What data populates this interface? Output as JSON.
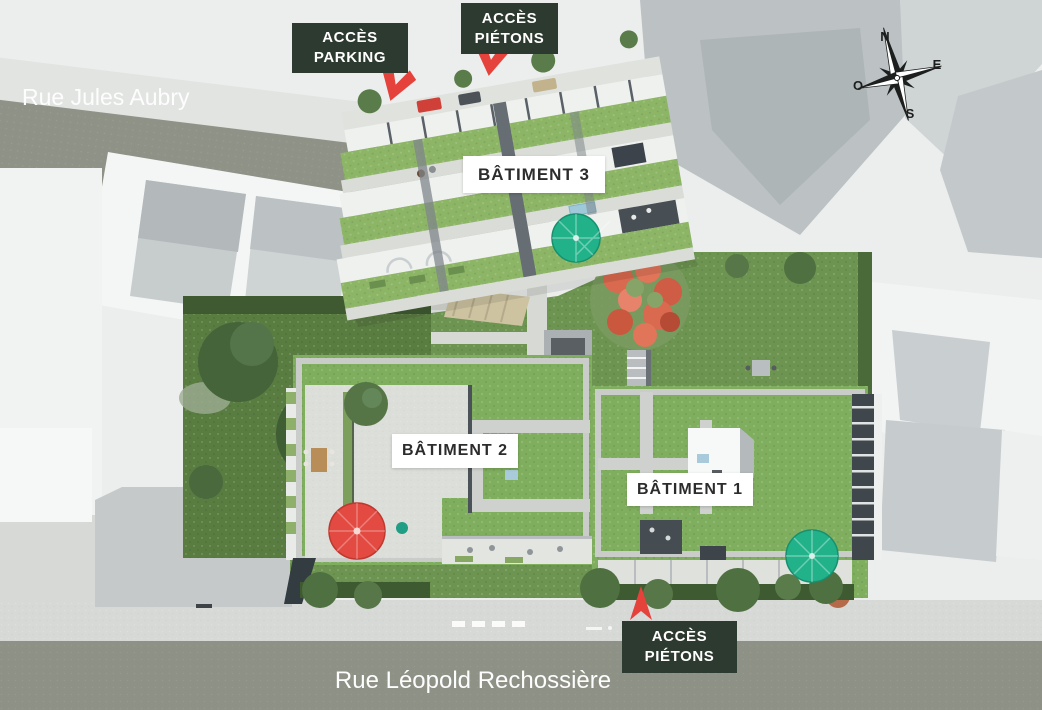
{
  "map": {
    "streets": {
      "top": "Rue Jules Aubry",
      "bottom": "Rue Léopold Rechossière"
    },
    "access": {
      "parking": {
        "line1": "ACCÈS",
        "line2": "PARKING"
      },
      "pedestrian_top": {
        "line1": "ACCÈS",
        "line2": "PIÉTONS"
      },
      "pedestrian_bottom": {
        "line1": "ACCÈS",
        "line2": "PIÉTONS"
      }
    },
    "buildings": {
      "b1": "BÂTIMENT 1",
      "b2": "BÂTIMENT 2",
      "b3": "BÂTIMENT 3"
    },
    "compass": {
      "north": "N",
      "east": "E",
      "south": "S",
      "west": "O"
    },
    "colors": {
      "label_box_green": "#2d3a30",
      "accent_red": "#e5423b",
      "accent_teal": "#22b28a",
      "street_gray": "#8e9186",
      "sidewalk_gray": "#d7d9d7",
      "roof_lawn_green": "#7fae5e",
      "garden_green": "#6d9551",
      "garden_dark_green": "#597c41",
      "background_gray": "#eceeed"
    }
  }
}
